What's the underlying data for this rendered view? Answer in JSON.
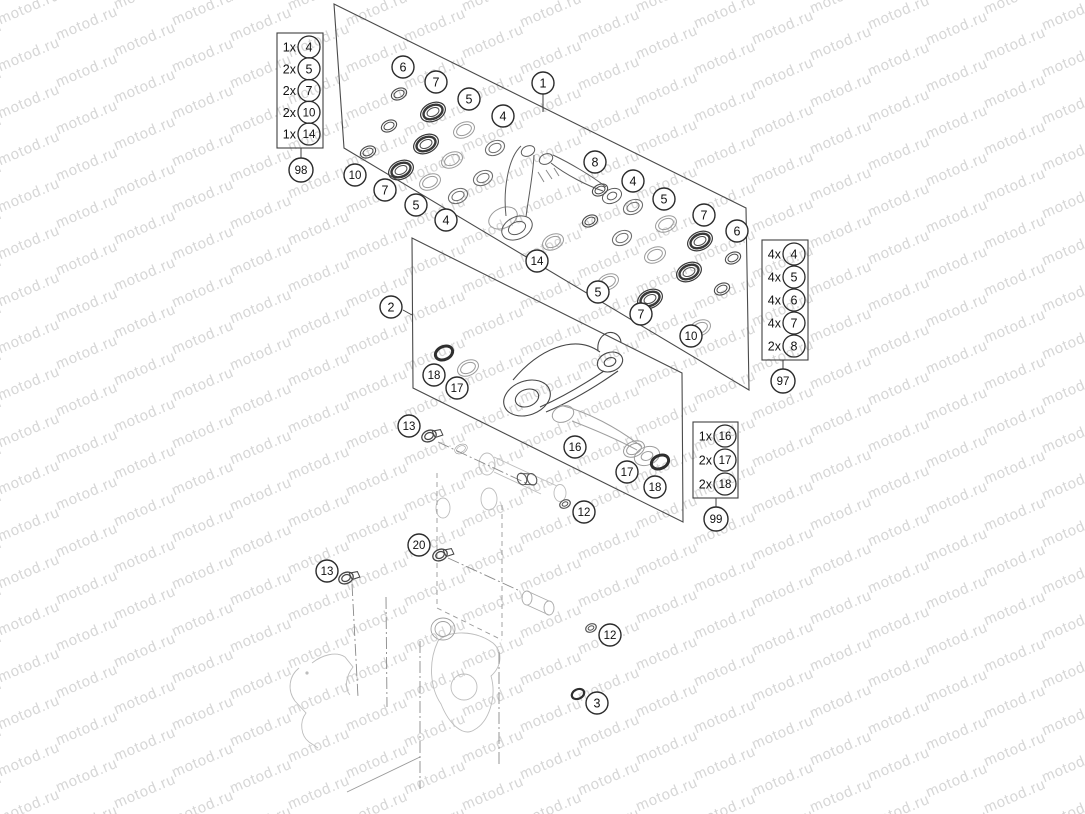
{
  "watermark": {
    "text": "motod.ru",
    "color": "#d6d6d6",
    "angle_deg": -23,
    "col_step_x": 58,
    "col_drift_y": 16,
    "row_step_y": 47
  },
  "colors": {
    "background": "#ffffff",
    "line": "#3f3f3f",
    "panel": "#4a4a4a",
    "faint": "#bdbdbd",
    "callout_stroke": "#2b2b2b",
    "callout_fill": "#ffffff",
    "text": "#111111"
  },
  "diagram": {
    "panels": {
      "p1": {
        "points": "334,4 746,208 749,390 344,148"
      },
      "p2": {
        "points": "412,238 682,373 683,522 413,388"
      }
    },
    "callouts": [
      {
        "n": "1",
        "x": 543,
        "y": 83,
        "leader": [
          543,
          94,
          543,
          112
        ]
      },
      {
        "n": "2",
        "x": 391,
        "y": 307,
        "leader": [
          403,
          310,
          412,
          315
        ]
      },
      {
        "n": "6",
        "x": 403,
        "y": 67
      },
      {
        "n": "7",
        "x": 436,
        "y": 82
      },
      {
        "n": "5",
        "x": 469,
        "y": 99
      },
      {
        "n": "4",
        "x": 503,
        "y": 116
      },
      {
        "n": "8",
        "x": 595,
        "y": 162
      },
      {
        "n": "4",
        "x": 633,
        "y": 181
      },
      {
        "n": "5",
        "x": 664,
        "y": 199
      },
      {
        "n": "7",
        "x": 704,
        "y": 215
      },
      {
        "n": "6",
        "x": 737,
        "y": 231
      },
      {
        "n": "10",
        "x": 355,
        "y": 175
      },
      {
        "n": "7",
        "x": 385,
        "y": 190
      },
      {
        "n": "5",
        "x": 416,
        "y": 205
      },
      {
        "n": "4",
        "x": 446,
        "y": 220
      },
      {
        "n": "14",
        "x": 537,
        "y": 261
      },
      {
        "n": "5",
        "x": 598,
        "y": 292
      },
      {
        "n": "7",
        "x": 641,
        "y": 314
      },
      {
        "n": "10",
        "x": 691,
        "y": 336
      },
      {
        "n": "18",
        "x": 434,
        "y": 375
      },
      {
        "n": "17",
        "x": 457,
        "y": 388
      },
      {
        "n": "13",
        "x": 409,
        "y": 426
      },
      {
        "n": "16",
        "x": 575,
        "y": 447
      },
      {
        "n": "17",
        "x": 627,
        "y": 472
      },
      {
        "n": "18",
        "x": 655,
        "y": 487
      },
      {
        "n": "12",
        "x": 584,
        "y": 512
      },
      {
        "n": "20",
        "x": 419,
        "y": 545
      },
      {
        "n": "13",
        "x": 327,
        "y": 571
      },
      {
        "n": "12",
        "x": 610,
        "y": 635
      },
      {
        "n": "3",
        "x": 597,
        "y": 703
      }
    ],
    "legends": [
      {
        "ref": "98",
        "x": 277,
        "y": 33,
        "w": 46,
        "h": 115,
        "cx": 301,
        "cy": 170,
        "items": [
          {
            "qty": "1x",
            "num": "4"
          },
          {
            "qty": "2x",
            "num": "5"
          },
          {
            "qty": "2x",
            "num": "7"
          },
          {
            "qty": "2x",
            "num": "10"
          },
          {
            "qty": "1x",
            "num": "14"
          }
        ]
      },
      {
        "ref": "97",
        "x": 762,
        "y": 240,
        "w": 46,
        "h": 120,
        "cx": 783,
        "cy": 381,
        "items": [
          {
            "qty": "4x",
            "num": "4"
          },
          {
            "qty": "4x",
            "num": "5"
          },
          {
            "qty": "4x",
            "num": "6"
          },
          {
            "qty": "4x",
            "num": "7"
          },
          {
            "qty": "2x",
            "num": "8"
          }
        ]
      },
      {
        "ref": "99",
        "x": 693,
        "y": 422,
        "w": 45,
        "h": 76,
        "cx": 716,
        "cy": 519,
        "items": [
          {
            "qty": "1x",
            "num": "16"
          },
          {
            "qty": "2x",
            "num": "17"
          },
          {
            "qty": "2x",
            "num": "18"
          }
        ]
      }
    ],
    "parts": [
      {
        "type": "oring",
        "x": 399,
        "y": 94
      },
      {
        "type": "oring",
        "x": 389,
        "y": 126
      },
      {
        "type": "oring",
        "x": 368,
        "y": 152
      },
      {
        "type": "bearing",
        "x": 433,
        "y": 112
      },
      {
        "type": "bearing",
        "x": 426,
        "y": 144
      },
      {
        "type": "bearing",
        "x": 401,
        "y": 170
      },
      {
        "type": "washer",
        "x": 464,
        "y": 130
      },
      {
        "type": "washer",
        "x": 452,
        "y": 160
      },
      {
        "type": "washer",
        "x": 430,
        "y": 182
      },
      {
        "type": "seal",
        "x": 495,
        "y": 148
      },
      {
        "type": "seal",
        "x": 483,
        "y": 178
      },
      {
        "type": "seal",
        "x": 458,
        "y": 196
      },
      {
        "type": "oring",
        "x": 600,
        "y": 190
      },
      {
        "type": "oring",
        "x": 590,
        "y": 221
      },
      {
        "type": "seal",
        "x": 633,
        "y": 207
      },
      {
        "type": "seal",
        "x": 622,
        "y": 238
      },
      {
        "type": "washer",
        "x": 666,
        "y": 224
      },
      {
        "type": "washer",
        "x": 655,
        "y": 255
      },
      {
        "type": "bearing",
        "x": 700,
        "y": 241
      },
      {
        "type": "bearing",
        "x": 689,
        "y": 272
      },
      {
        "type": "oring",
        "x": 733,
        "y": 258
      },
      {
        "type": "oring",
        "x": 722,
        "y": 289
      },
      {
        "type": "washer",
        "x": 608,
        "y": 282
      },
      {
        "type": "bearing",
        "x": 650,
        "y": 299
      },
      {
        "type": "washer",
        "x": 700,
        "y": 328
      },
      {
        "type": "washer",
        "x": 553,
        "y": 242
      },
      {
        "type": "odark",
        "x": 444,
        "y": 353
      },
      {
        "type": "washer",
        "x": 468,
        "y": 368
      },
      {
        "type": "washer",
        "x": 634,
        "y": 449
      },
      {
        "type": "odark",
        "x": 660,
        "y": 462
      },
      {
        "type": "tiny",
        "x": 565,
        "y": 504
      },
      {
        "type": "tiny",
        "x": 591,
        "y": 628
      },
      {
        "type": "odark",
        "x": 578,
        "y": 694,
        "s": 0.72
      },
      {
        "type": "bolt",
        "x": 429,
        "y": 436
      },
      {
        "type": "bolt",
        "x": 346,
        "y": 578
      },
      {
        "type": "bolt",
        "x": 440,
        "y": 555
      },
      {
        "type": "sleeve",
        "x": 522,
        "y": 479
      },
      {
        "type": "washer",
        "x": 461,
        "y": 449,
        "s": 0.6
      }
    ],
    "centerlines": [
      [
        438,
        442,
        526,
        483
      ],
      [
        448,
        558,
        520,
        591
      ],
      [
        352,
        584,
        358,
        697
      ],
      [
        386,
        597,
        387,
        707
      ],
      [
        420,
        641,
        420,
        789
      ],
      [
        499,
        652,
        499,
        764
      ]
    ],
    "dashed_box": [
      [
        437,
        473,
        437,
        608
      ],
      [
        502,
        505,
        502,
        640
      ],
      [
        437,
        608,
        502,
        640
      ]
    ]
  }
}
